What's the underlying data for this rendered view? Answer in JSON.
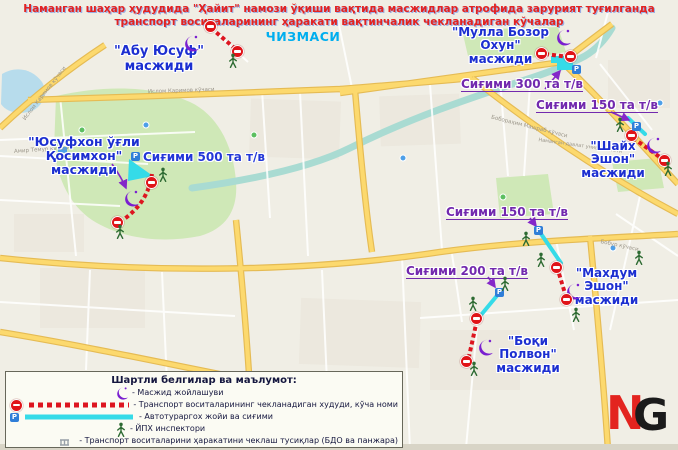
{
  "title": {
    "line1": "Наманган шаҳар ҳудудида \"Ҳайит\" намози ўқиши вақтида масжидлар атрофида зарурият туғилганда",
    "line2": "транспорт воситаларининг ҳаракати вақтинчалик чекланадиган кўчалар",
    "line3": "ЧИЗМАСИ"
  },
  "mosques": [
    {
      "name": "\"Абу Юсуф\"",
      "type": "масжиди"
    },
    {
      "name": "\"Мулла Бозор Охун\"",
      "type": "масжиди"
    },
    {
      "name": "\"Шайх Эшон\"",
      "type": "масжиди"
    },
    {
      "name": "\"Юсуфхон ўғли Қосимхон\"",
      "type": "масжиди"
    },
    {
      "name": "\"Махдум Эшон\"",
      "type": "масжиди"
    },
    {
      "name": "\"Боқи Полвон\"",
      "type": "масжиди"
    }
  ],
  "capacities": [
    "Сиғими 500 та т/в",
    "Сиғими 300 та т/в",
    "Сиғими 150 та т/в",
    "Сиғими 150 та т/в",
    "Сиғими 200 та т/в"
  ],
  "legend": {
    "title": "Шартли белгилар ва маълумот:",
    "items": [
      "- Масжид жойлашуви",
      "- Транспорт воситаларининг чекланадиган худуди, кўча номи",
      "- Автотураргох жойи ва сиғими",
      "- ЙПХ инспектори",
      "- Транспорт воситаларини ҳаракатини чеклаш тусиқлар (БДО ва панжара)"
    ]
  },
  "map": {
    "streets": [
      "Ислом Каримов кўчаси",
      "Амир Темур кўчаси",
      "Бобораҳим Машраб кўчаси",
      "Бобур кўчаси"
    ],
    "poi_university": "Наманган давлат университети",
    "parking_letter": "P"
  },
  "logo": {
    "n": "N",
    "g": "G"
  },
  "colors": {
    "restricted_red": "#dd1520",
    "parking_cyan": "#35dbe8",
    "mosque_label_blue": "#1c2fd1",
    "capacity_purple": "#7229ae",
    "title_red": "#e32321",
    "title_cyan": "#00aeef",
    "mosque_icon_purple": "#7a1fd0",
    "inspector_green": "#2e6b33"
  }
}
